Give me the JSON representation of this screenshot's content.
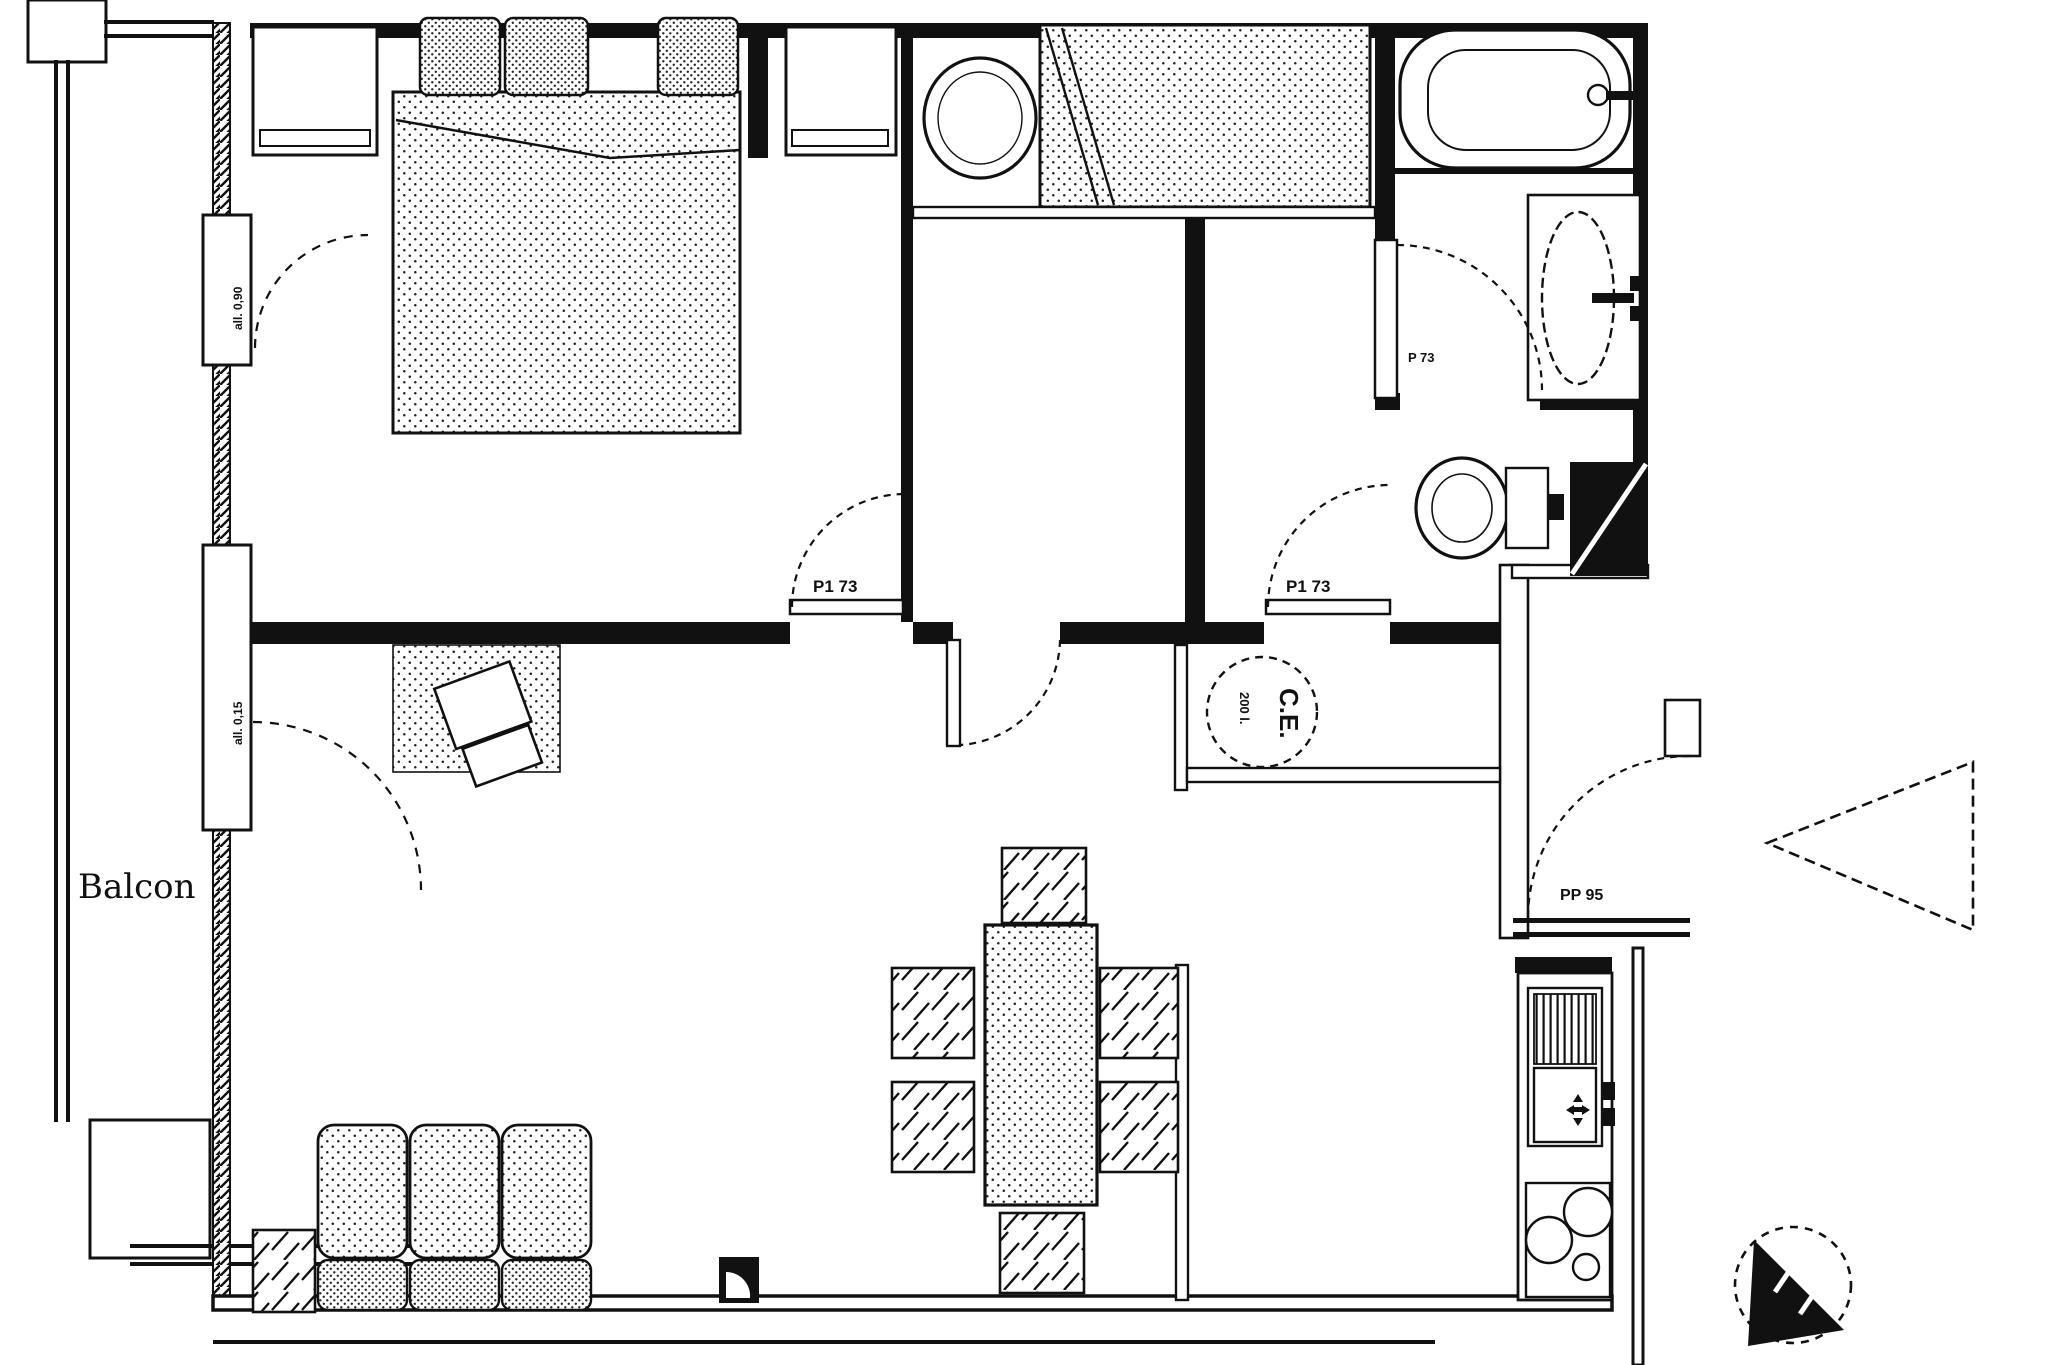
{
  "labels": {
    "balcony": "Balcon",
    "door_bedroom1": "P1 73",
    "door_sanitary": "P1 73",
    "door_bathroom": "P 73",
    "door_entrance": "PP 95",
    "water_heater_title": "C.E.",
    "water_heater_capacity": "200 l.",
    "window_bedroom_sill": "all. 0,90",
    "window_living_sill": "all. 0,15"
  },
  "colors": {
    "line": "#111111",
    "background": "#ffffff"
  }
}
